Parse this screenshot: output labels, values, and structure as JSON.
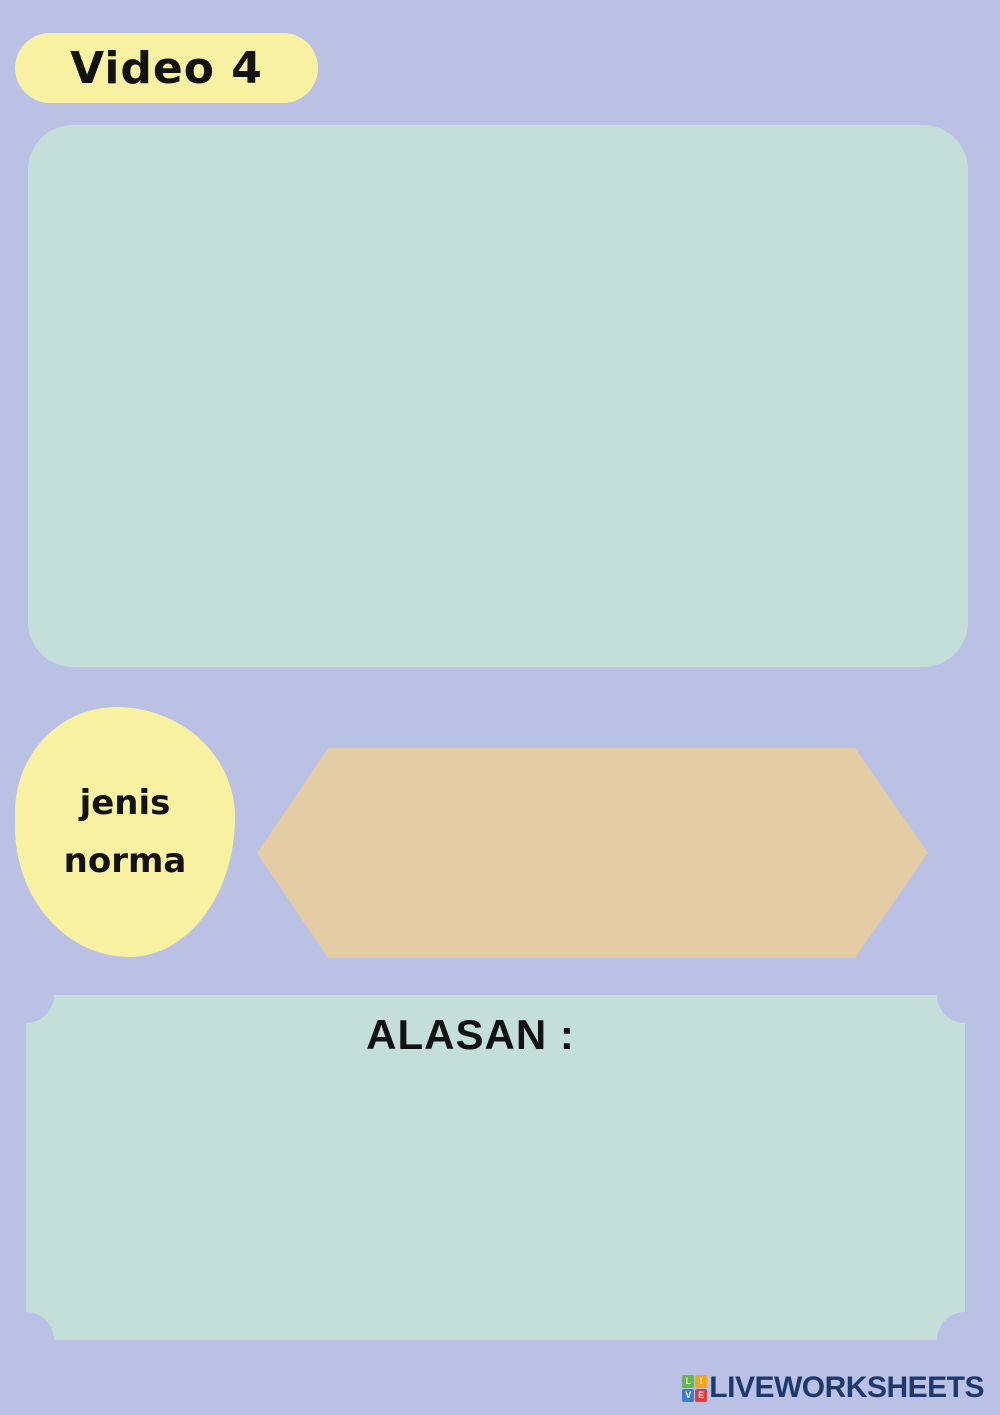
{
  "theme": {
    "background": "#bac1e4",
    "panel_teal": "#c4deda",
    "accent_yellow": "#f8f1a2",
    "accent_tan": "#e4cda5",
    "logo_navy": "#1e3a6d",
    "text_black": "#131313"
  },
  "badge": {
    "label": "Video 4"
  },
  "jenis_norma_label": {
    "line1": "jenis",
    "line2": "norma"
  },
  "alasan_box": {
    "heading": "ALASAN :"
  },
  "footer": {
    "logo_text": "LIVEWORKSHEETS",
    "logo_tiles": [
      {
        "letter": "L",
        "color": "#5fb94e"
      },
      {
        "letter": "I",
        "color": "#f7a31c"
      },
      {
        "letter": "V",
        "color": "#3d7cc9"
      },
      {
        "letter": "E",
        "color": "#e23b3b"
      }
    ]
  }
}
